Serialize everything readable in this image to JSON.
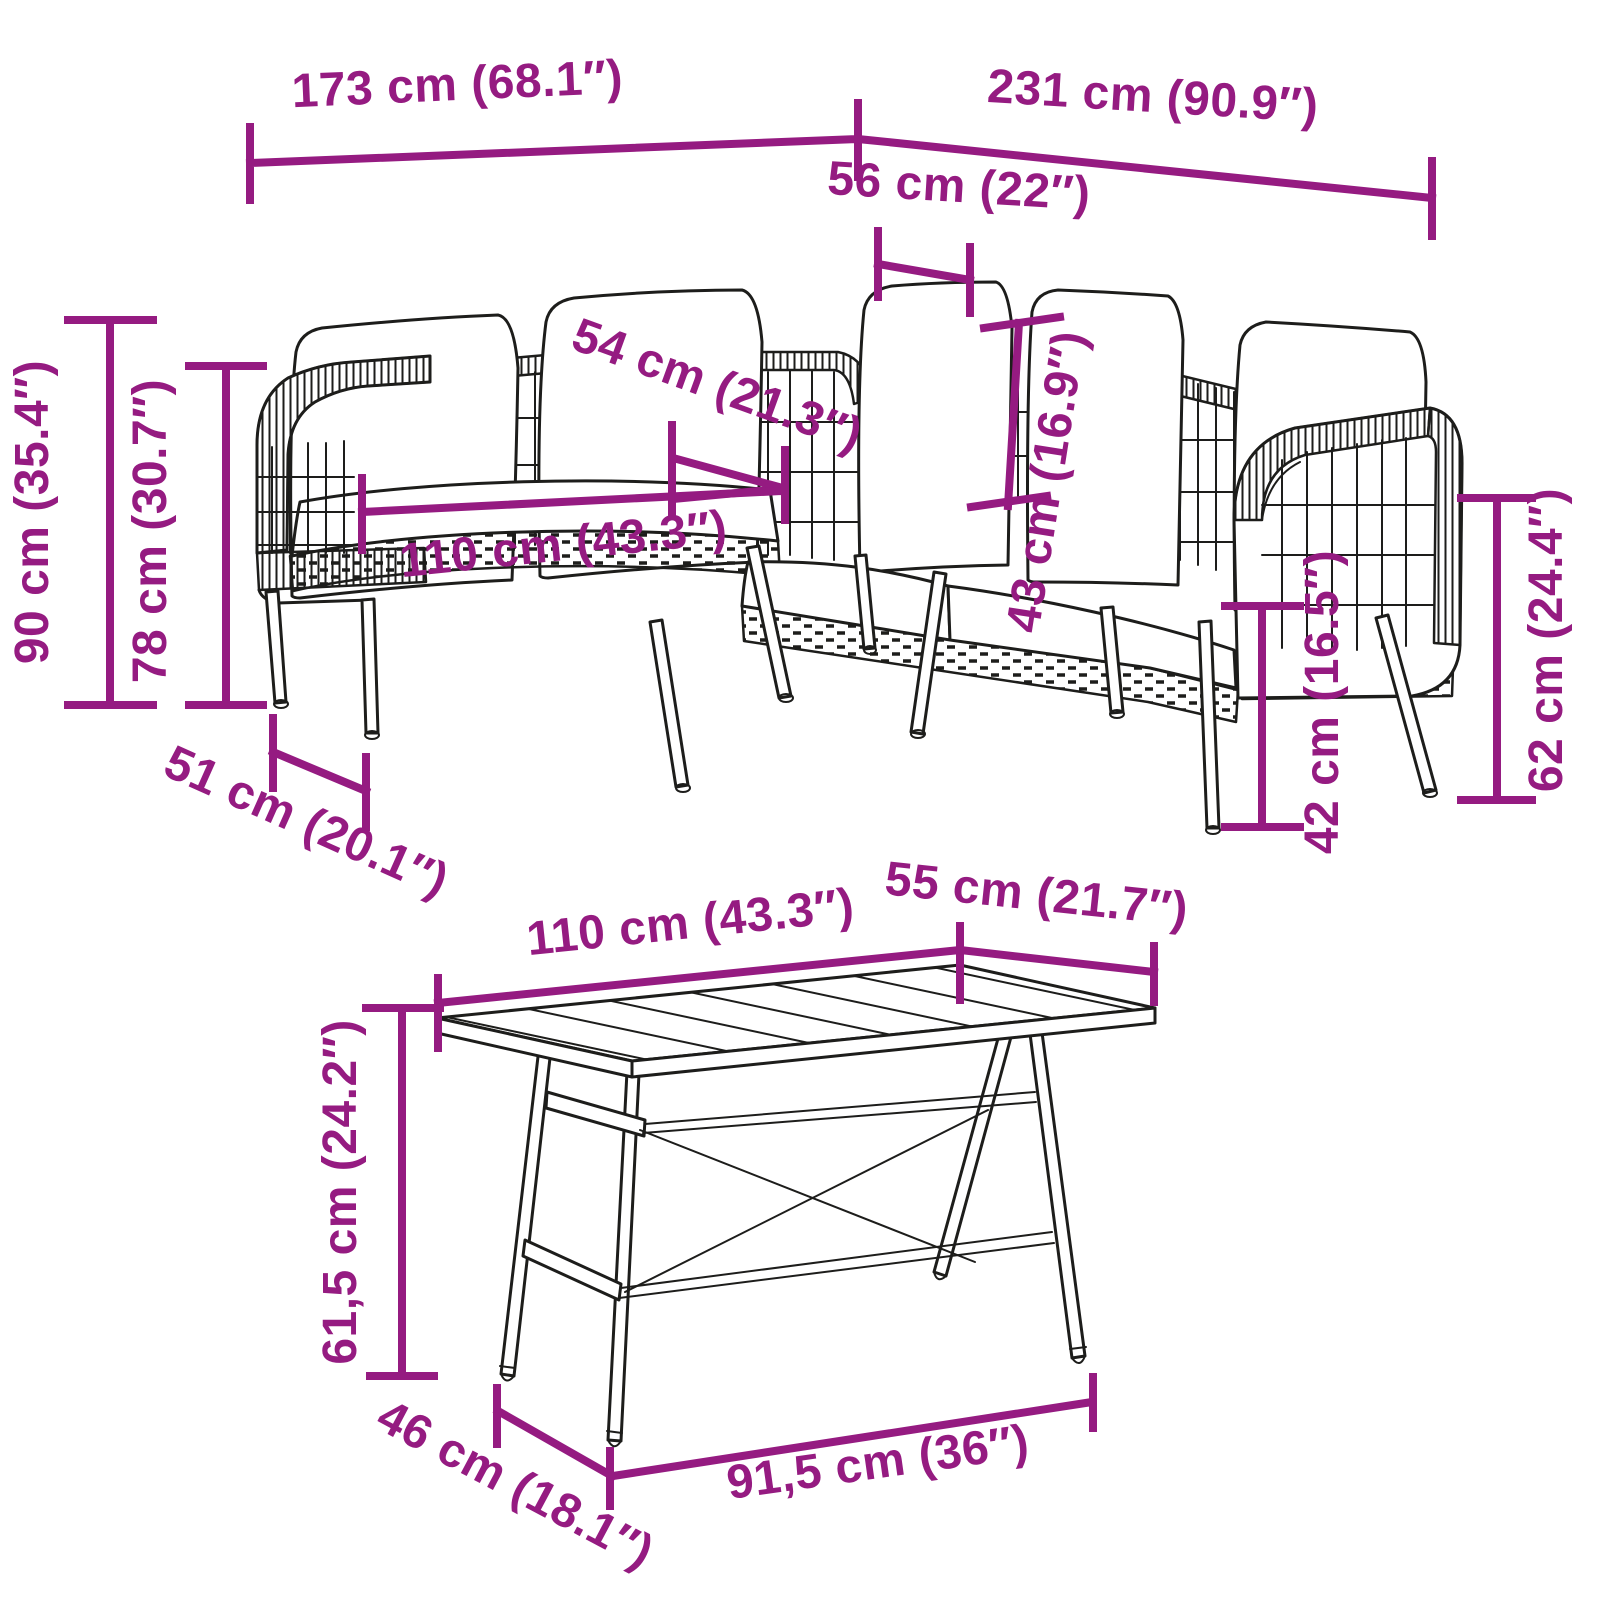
{
  "diagram": {
    "type": "product-dimension-diagram",
    "background": "#ffffff",
    "accent_color": "#951b81",
    "line_art_color": "#1d1d1b",
    "items": [
      "corner-sofa-with-cushions",
      "garden-dining-table"
    ],
    "sofa": {
      "name": "rattan-corner-sofa",
      "dimensions": {
        "total_length_left": "173 cm (68.1″)",
        "total_length_right": "231 cm (90.9″)",
        "corner_seat_depth": "56 cm (22″)",
        "seat_width": "54 cm (21.3″)",
        "backrest_height": "43 cm (16.9″)",
        "total_height": "90 cm (35.4″)",
        "back_height": "78 cm (30.7″)",
        "seat_length": "110 cm (43.3″)",
        "seat_depth": "51 cm (20.1″)",
        "seat_height": "42 cm (16.5″)",
        "armrest_height": "62 cm (24.4″)"
      }
    },
    "table": {
      "name": "garden-table",
      "dimensions": {
        "top_length": "110 cm (43.3″)",
        "top_width": "55 cm (21.7″)",
        "height": "61,5 cm (24.2″)",
        "leg_span_depth": "46 cm (18.1″)",
        "leg_span_length": "91,5 cm (36″)"
      }
    }
  }
}
